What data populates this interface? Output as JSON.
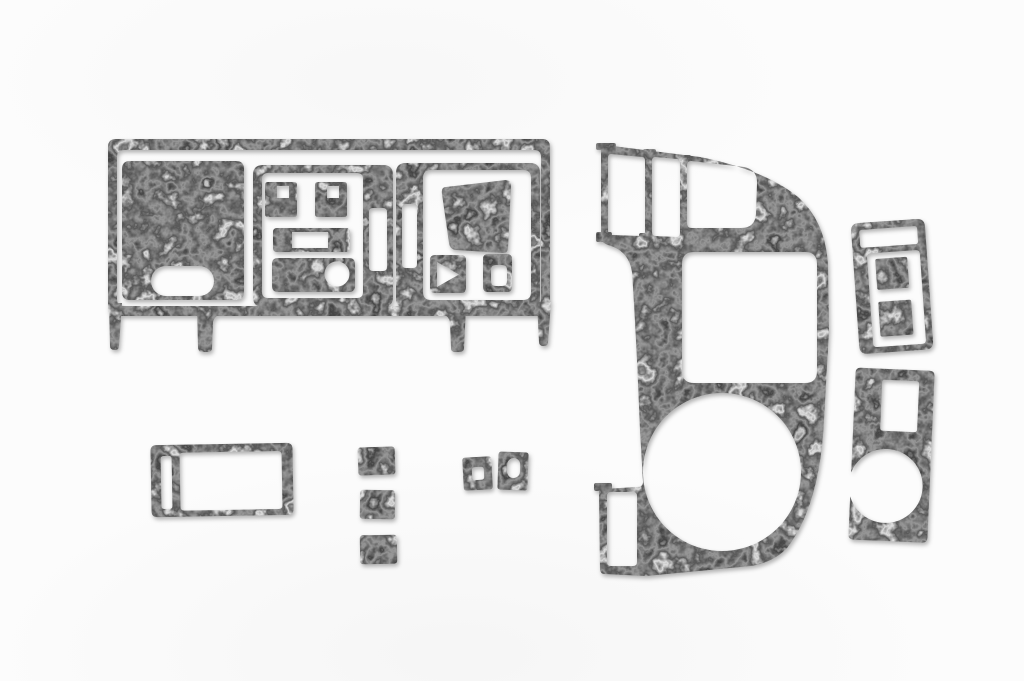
{
  "page": {
    "title": "Grey burl dash trim kit — product photo",
    "description": "Ten loose dashboard trim overlay pieces with a swirled grey burl-wood finish, photographed flat on a plain white background with soft shadows"
  },
  "colors": {
    "page_background": "#fcfcfc",
    "texture_light": "#d2d2d2",
    "texture_mid": "#929292",
    "texture_dark": "#4f4f4f",
    "shadow": "rgba(0,0,0,0.30)"
  },
  "pieces": [
    {
      "name": "dashboard-fascia-panel",
      "description": "Wide main dashboard fascia: thin outer frame with four lower mounting legs; inside are a solid instrument-cluster blank with an oblong cutout, a center switch panel with two switch squares, a slotted bar and a knob bar with round hole, plus a right panel with vertical slot, display trapezoid, triangle-marked switch square and small vent square"
    },
    {
      "name": "center-console-panel",
      "description": "Large D-shaped center console panel: three vent slots at the top left, a big rounded-square opening in the middle, a large round gauge opening at the bottom that almost meets the left edge, and a narrow slot at the lower left"
    },
    {
      "name": "upper-switch-pod-bezel",
      "description": "Small vertical bezel with a top slot opening and a framed opening containing two solid switch squares"
    },
    {
      "name": "lower-console-bezel",
      "description": "Small vertical bezel with a rectangular opening at the top and a large round cupholder opening that breaks through its left edge"
    },
    {
      "name": "pocket-trim-frame",
      "description": "Rectangular frame with a narrow vertical slot on the left and a wide rectangular opening"
    },
    {
      "name": "switch-blank-square-1",
      "description": "Solid square switch blank (top of stack of three)"
    },
    {
      "name": "switch-blank-square-2",
      "description": "Solid square switch blank (middle of stack of three)"
    },
    {
      "name": "switch-blank-square-3",
      "description": "Solid square switch blank (bottom of stack of three)"
    },
    {
      "name": "small-switch-bezel-square-hole",
      "description": "Small square bezel with a rounded square hole"
    },
    {
      "name": "small-switch-bezel-oval-hole",
      "description": "Small square bezel with a vertical oval hole"
    }
  ]
}
